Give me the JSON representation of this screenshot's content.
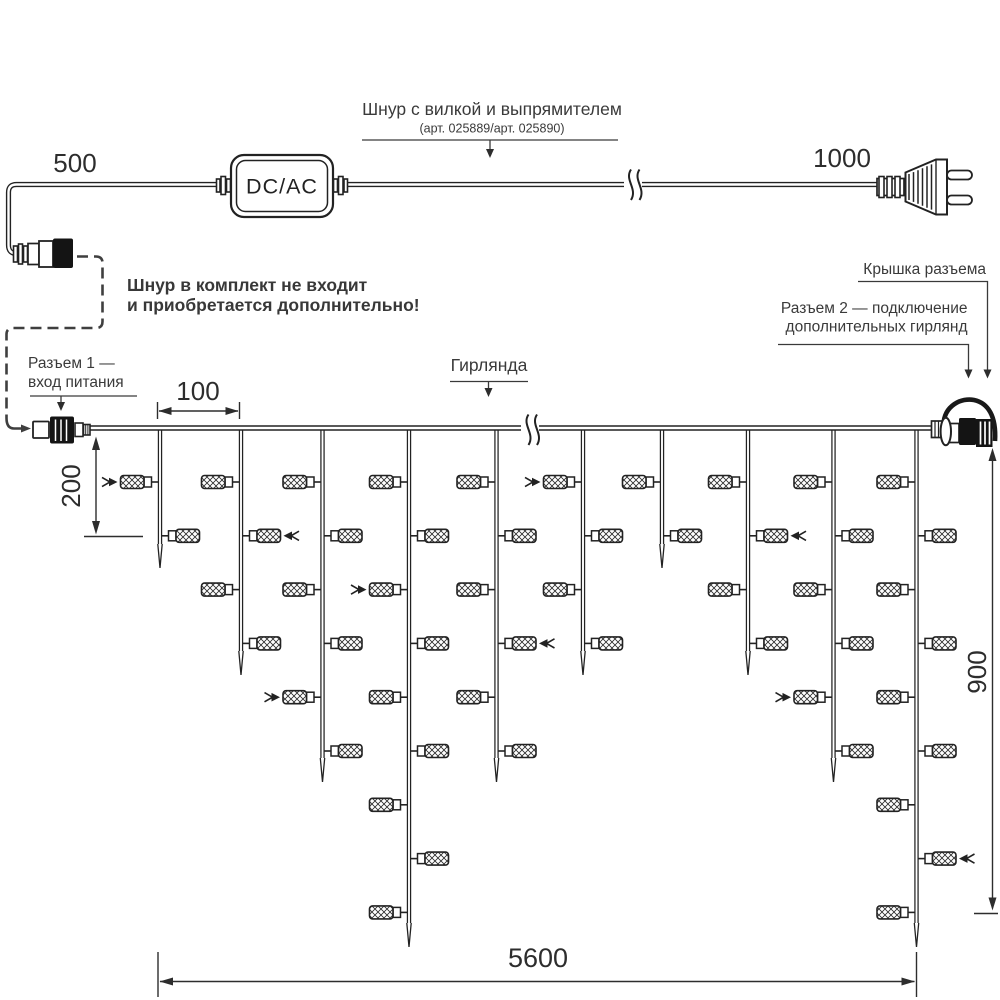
{
  "colors": {
    "ink": "#222222",
    "text": "#3a3a3a"
  },
  "power_cord": {
    "len_left": "500",
    "len_right": "1000",
    "converter": "DC/AC",
    "title": "Шнур с вилкой и выпрямителем",
    "article": "(арт. 025889/арт. 025890)",
    "note1": "Шнур в комплект не входит",
    "note2": "и приобретается дополнительно!"
  },
  "garland": {
    "label": "Гирлянда",
    "conn1_l1": "Разъем 1 —",
    "conn1_l2": "вход питания",
    "cap_label": "Крышка разъема",
    "conn2_l1": "Разъем 2 — подключение",
    "conn2_l2": "дополнительных гирлянд",
    "dim_spacing": "100",
    "dim_first_drop": "200",
    "dim_height": "900",
    "dim_length": "5600",
    "drops": [
      {
        "lamp_count": 2,
        "arrow_row": 1
      },
      {
        "lamp_count": 4,
        "arrow_row": 2
      },
      {
        "lamp_count": 6,
        "arrow_row": 5
      },
      {
        "lamp_count": 9,
        "arrow_row": 3
      },
      {
        "lamp_count": 6,
        "arrow_row": 4
      },
      {
        "lamp_count": 4,
        "arrow_row": 1
      },
      {
        "lamp_count": 2,
        "arrow_row": null
      },
      {
        "lamp_count": 4,
        "arrow_row": 2
      },
      {
        "lamp_count": 6,
        "arrow_row": 5
      },
      {
        "lamp_count": 9,
        "arrow_row": 8
      }
    ]
  }
}
